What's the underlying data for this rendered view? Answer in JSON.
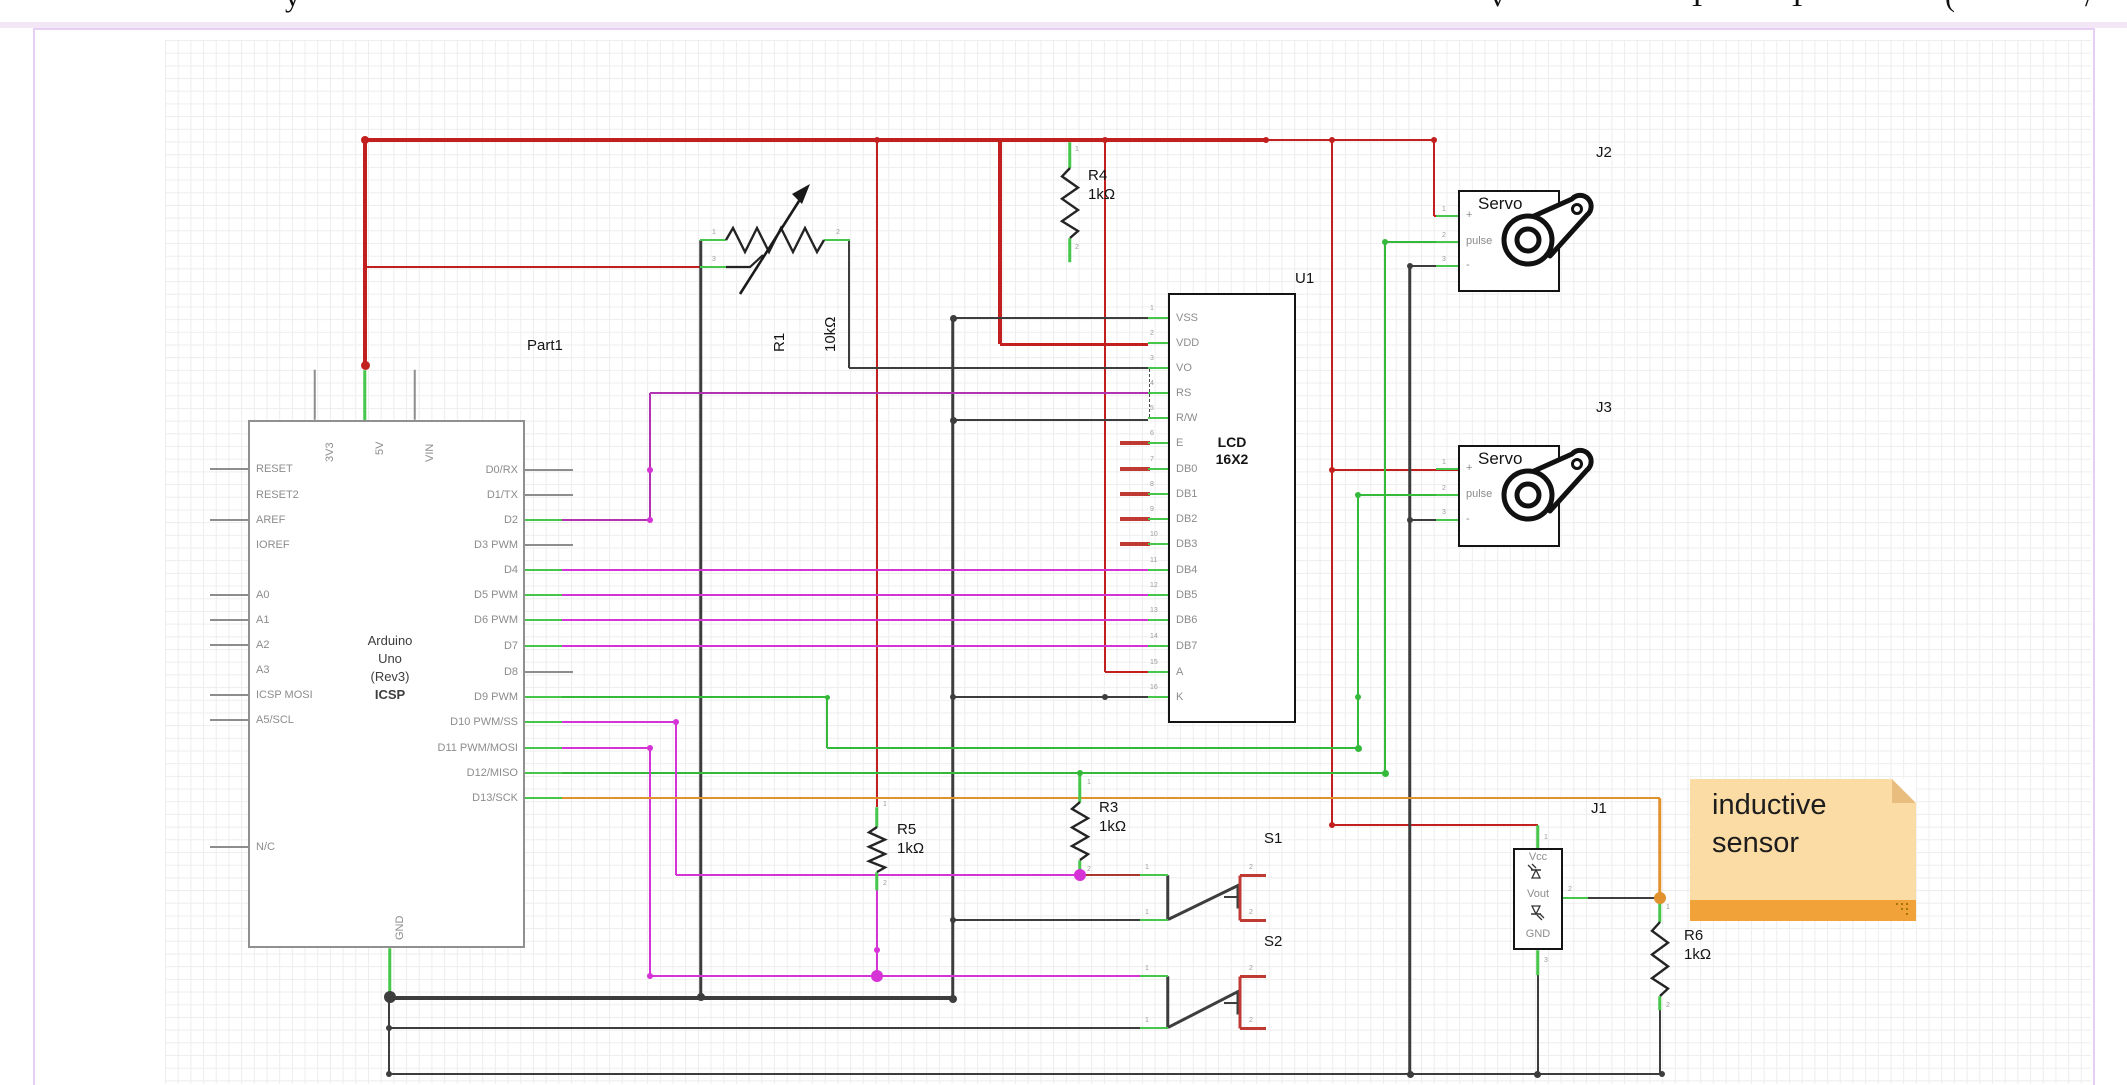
{
  "palette": {
    "r": "#c2201f",
    "dr": "#a8372f",
    "k": "#3d3d3d",
    "g": "#35b93a",
    "s": "#46c64b",
    "m": "#d633d6",
    "p": "#b233b2",
    "o": "#e1912d",
    "gy": "#8d8d8d",
    "rs": "#c03a34"
  },
  "title_fragments": [
    {
      "t": "y",
      "x": 285
    },
    {
      "t": "v",
      "x": 1490
    },
    {
      "t": "T",
      "x": 1688
    },
    {
      "t": "T",
      "x": 1788
    },
    {
      "t": "(",
      "x": 1945
    },
    {
      "t": "/",
      "x": 2085
    }
  ],
  "arduino": {
    "ref": "Part1",
    "ref_pos": {
      "x": 527,
      "y": 337
    },
    "box": {
      "x": 248,
      "y": 420,
      "w": 277,
      "h": 528
    },
    "title_lines": [
      "Arduino",
      "Uno",
      "(Rev3)",
      "ICSP"
    ],
    "top_pins": [
      {
        "label": "3V3",
        "x": 315,
        "stub": "gray"
      },
      {
        "label": "5V",
        "x": 365,
        "stub": "green"
      },
      {
        "label": "VIN",
        "x": 415,
        "stub": "gray"
      }
    ],
    "bottom_pins": [
      {
        "label": "GND",
        "x": 390
      }
    ],
    "left_pins": [
      {
        "label": "RESET",
        "y": 469,
        "stub": true
      },
      {
        "label": "RESET2",
        "y": 495,
        "stub": false
      },
      {
        "label": "AREF",
        "y": 520,
        "stub": true
      },
      {
        "label": "IOREF",
        "y": 545,
        "stub": false
      },
      {
        "label": "A0",
        "y": 595,
        "stub": true
      },
      {
        "label": "A1",
        "y": 620,
        "stub": true
      },
      {
        "label": "A2",
        "y": 645,
        "stub": true
      },
      {
        "label": "A3",
        "y": 670,
        "stub": false
      },
      {
        "label": "ICSP MOSI",
        "y": 695,
        "stub": true
      },
      {
        "label": "A5/SCL",
        "y": 720,
        "stub": true
      },
      {
        "label": "N/C",
        "y": 847,
        "stub": true
      }
    ],
    "right_pins": [
      {
        "label": "D0/RX",
        "y": 470,
        "stub": "gray"
      },
      {
        "label": "D1/TX",
        "y": 495,
        "stub": "gray"
      },
      {
        "label": "D2",
        "y": 520,
        "stub": "green"
      },
      {
        "label": "D3 PWM",
        "y": 545,
        "stub": "gray"
      },
      {
        "label": "D4",
        "y": 570,
        "stub": "green"
      },
      {
        "label": "D5 PWM",
        "y": 595,
        "stub": "green"
      },
      {
        "label": "D6 PWM",
        "y": 620,
        "stub": "green"
      },
      {
        "label": "D7",
        "y": 646,
        "stub": "green"
      },
      {
        "label": "D8",
        "y": 672,
        "stub": "gray"
      },
      {
        "label": "D9 PWM",
        "y": 697,
        "stub": "green"
      },
      {
        "label": "D10 PWM/SS",
        "y": 722,
        "stub": "green"
      },
      {
        "label": "D11 PWM/MOSI",
        "y": 748,
        "stub": "green"
      },
      {
        "label": "D12/MISO",
        "y": 773,
        "stub": "green"
      },
      {
        "label": "D13/SCK",
        "y": 798,
        "stub": "green"
      }
    ]
  },
  "lcd": {
    "ref": "U1",
    "ref_pos": {
      "x": 1295,
      "y": 270
    },
    "box": {
      "x": 1168,
      "y": 293,
      "w": 128,
      "h": 430
    },
    "name_lines": [
      "LCD",
      "16X2"
    ],
    "pins": [
      {
        "n": 1,
        "label": "VSS",
        "y": 318,
        "stub": "green"
      },
      {
        "n": 2,
        "label": "VDD",
        "y": 343,
        "stub": "green"
      },
      {
        "n": 3,
        "label": "VO",
        "y": 368,
        "stub": "green"
      },
      {
        "n": 4,
        "label": "RS",
        "y": 393,
        "stub": "green"
      },
      {
        "n": 5,
        "label": "R/W",
        "y": 418,
        "stub": "green"
      },
      {
        "n": 6,
        "label": "E",
        "y": 443,
        "stub": "red"
      },
      {
        "n": 7,
        "label": "DB0",
        "y": 469,
        "stub": "red"
      },
      {
        "n": 8,
        "label": "DB1",
        "y": 494,
        "stub": "red"
      },
      {
        "n": 9,
        "label": "DB2",
        "y": 519,
        "stub": "red"
      },
      {
        "n": 10,
        "label": "DB3",
        "y": 544,
        "stub": "red"
      },
      {
        "n": 11,
        "label": "DB4",
        "y": 570,
        "stub": "green"
      },
      {
        "n": 12,
        "label": "DB5",
        "y": 595,
        "stub": "green"
      },
      {
        "n": 13,
        "label": "DB6",
        "y": 620,
        "stub": "green"
      },
      {
        "n": 14,
        "label": "DB7",
        "y": 646,
        "stub": "green"
      },
      {
        "n": 15,
        "label": "A",
        "y": 672,
        "stub": "green"
      },
      {
        "n": 16,
        "label": "K",
        "y": 697,
        "stub": "green"
      }
    ]
  },
  "servos": [
    {
      "ref": "J2",
      "ref_pos": {
        "x": 1596,
        "y": 144
      },
      "title": "Servo",
      "box": {
        "x": 1458,
        "y": 190,
        "w": 102,
        "h": 102
      },
      "pins": [
        {
          "n": 1,
          "label": "+",
          "y": 216
        },
        {
          "n": 2,
          "label": "pulse",
          "y": 242
        },
        {
          "n": 3,
          "label": "-",
          "y": 266
        }
      ]
    },
    {
      "ref": "J3",
      "ref_pos": {
        "x": 1596,
        "y": 399
      },
      "title": "Servo",
      "box": {
        "x": 1458,
        "y": 445,
        "w": 102,
        "h": 102
      },
      "pins": [
        {
          "n": 1,
          "label": "+",
          "y": 469
        },
        {
          "n": 2,
          "label": "pulse",
          "y": 495
        },
        {
          "n": 3,
          "label": "-",
          "y": 520
        }
      ]
    }
  ],
  "connector": {
    "ref": "J1",
    "ref_pos": {
      "x": 1591,
      "y": 800
    },
    "box": {
      "x": 1513,
      "y": 848,
      "w": 50,
      "h": 102
    },
    "pin_labels": [
      "Vcc",
      "Vout",
      "GND"
    ]
  },
  "switches": [
    {
      "ref": "S1",
      "ref_pos": {
        "x": 1264,
        "y": 830
      }
    },
    {
      "ref": "S2",
      "ref_pos": {
        "x": 1264,
        "y": 933
      }
    }
  ],
  "resistors": [
    {
      "ref": "R1",
      "value": "10kΩ",
      "type": "pot",
      "label": {
        "x": 737,
        "y": 352,
        "rot": true
      }
    },
    {
      "ref": "R4",
      "value": "1kΩ",
      "x": 1070,
      "y": 168,
      "len": 70,
      "label": {
        "x": 1088,
        "y": 166
      }
    },
    {
      "ref": "R5",
      "value": "1kΩ",
      "x": 877,
      "y": 827,
      "len": 45,
      "label": {
        "x": 897,
        "y": 820
      }
    },
    {
      "ref": "R3",
      "value": "1kΩ",
      "x": 1080,
      "y": 802,
      "len": 58,
      "label": {
        "x": 1099,
        "y": 798
      }
    },
    {
      "ref": "R6",
      "value": "1kΩ",
      "x": 1660,
      "y": 922,
      "len": 74,
      "label": {
        "x": 1684,
        "y": 926
      }
    }
  ],
  "note": {
    "lines": [
      "inductive",
      "sensor"
    ]
  },
  "wires": [
    [
      "r",
      365,
      140,
      1266,
      140,
      4
    ],
    [
      "r",
      1266,
      140,
      1434,
      140,
      2
    ],
    [
      "r",
      365,
      140,
      365,
      365,
      4
    ],
    [
      "r",
      1000,
      140,
      1000,
      344,
      4
    ],
    [
      "r",
      1000,
      344,
      1148,
      344,
      3
    ],
    [
      "r",
      365,
      267,
      700,
      267,
      2
    ],
    [
      "r",
      877,
      140,
      877,
      807,
      2
    ],
    [
      "r",
      1105,
      140,
      1105,
      672,
      2
    ],
    [
      "r",
      1105,
      672,
      1148,
      672,
      2
    ],
    [
      "r",
      1332,
      140,
      1332,
      825,
      2
    ],
    [
      "r",
      1332,
      470,
      1458,
      470,
      2
    ],
    [
      "r",
      1332,
      825,
      1538,
      825,
      2
    ],
    [
      "r",
      1434,
      140,
      1434,
      216,
      2
    ],
    [
      "r",
      1434,
      216,
      1458,
      216,
      2
    ],
    [
      "dr",
      1080,
      875,
      1142,
      875,
      2
    ],
    [
      "k",
      701,
      240,
      701,
      997,
      2.5
    ],
    [
      "k",
      849,
      240,
      849,
      368,
      2
    ],
    [
      "k",
      849,
      368,
      1148,
      368,
      2
    ],
    [
      "k",
      953,
      318,
      1148,
      318,
      2
    ],
    [
      "k",
      953,
      318,
      953,
      999,
      2.5
    ],
    [
      "k",
      953,
      420,
      1148,
      420,
      2
    ],
    [
      "k",
      953,
      697,
      1148,
      697,
      2
    ],
    [
      "k",
      953,
      920,
      1142,
      920,
      2
    ],
    [
      "k",
      390,
      998,
      953,
      998,
      4
    ],
    [
      "k",
      389,
      997,
      389,
      1074,
      2
    ],
    [
      "k",
      389,
      1028,
      1142,
      1028,
      2
    ],
    [
      "k",
      389,
      1074,
      1662,
      1074,
      2.5
    ],
    [
      "k",
      1410,
      266,
      1410,
      1074,
      2.5
    ],
    [
      "k",
      1410,
      266,
      1436,
      266,
      2
    ],
    [
      "k",
      1410,
      520,
      1458,
      520,
      2
    ],
    [
      "k",
      1588,
      898,
      1658,
      898,
      2
    ],
    [
      "k",
      1538,
      975,
      1538,
      1074,
      2
    ],
    [
      "k",
      1660,
      1010,
      1660,
      1074,
      2
    ],
    [
      "k",
      1168,
      875,
      1168,
      920,
      2.5
    ],
    [
      "k",
      1168,
      919,
      1240,
      884,
      2.5
    ],
    [
      "k",
      1238,
      886,
      1238,
      908,
      3
    ],
    [
      "k",
      1224,
      897,
      1238,
      897,
      2
    ],
    [
      "k",
      1168,
      976,
      1168,
      1028,
      2.5
    ],
    [
      "k",
      1168,
      1027,
      1240,
      990,
      2.5
    ],
    [
      "k",
      1238,
      992,
      1238,
      1014,
      3
    ],
    [
      "k",
      1224,
      1003,
      1238,
      1003,
      2
    ],
    [
      "rs",
      1240,
      875,
      1266,
      875,
      3
    ],
    [
      "rs",
      1240,
      875,
      1240,
      920,
      3
    ],
    [
      "rs",
      1240,
      920,
      1266,
      920,
      3
    ],
    [
      "rs",
      1240,
      976,
      1266,
      976,
      3
    ],
    [
      "rs",
      1240,
      976,
      1240,
      1028,
      3
    ],
    [
      "rs",
      1240,
      1028,
      1266,
      1028,
      3
    ],
    [
      "g",
      560,
      697,
      827,
      697,
      2
    ],
    [
      "g",
      827,
      697,
      827,
      748,
      2
    ],
    [
      "g",
      827,
      748,
      1358,
      748,
      2
    ],
    [
      "g",
      1358,
      748,
      1358,
      495,
      2
    ],
    [
      "g",
      1358,
      495,
      1458,
      495,
      2
    ],
    [
      "g",
      560,
      773,
      1385,
      773,
      2
    ],
    [
      "g",
      1385,
      773,
      1385,
      242,
      2
    ],
    [
      "g",
      1385,
      242,
      1458,
      242,
      2
    ],
    [
      "m",
      560,
      570,
      1148,
      570,
      2
    ],
    [
      "m",
      560,
      595,
      1148,
      595,
      2
    ],
    [
      "m",
      560,
      620,
      1148,
      620,
      2
    ],
    [
      "m",
      560,
      646,
      1148,
      646,
      2
    ],
    [
      "m",
      560,
      722,
      676,
      722,
      2
    ],
    [
      "m",
      676,
      722,
      676,
      875,
      2
    ],
    [
      "m",
      676,
      875,
      1080,
      875,
      2
    ],
    [
      "m",
      560,
      748,
      650,
      748,
      2
    ],
    [
      "m",
      650,
      748,
      650,
      976,
      2
    ],
    [
      "m",
      650,
      976,
      1142,
      976,
      2
    ],
    [
      "m",
      877,
      890,
      877,
      976,
      2
    ],
    [
      "p",
      560,
      520,
      650,
      520,
      2
    ],
    [
      "p",
      650,
      520,
      650,
      393,
      2
    ],
    [
      "p",
      650,
      393,
      1148,
      393,
      2
    ],
    [
      "o",
      560,
      798,
      1660,
      798,
      2.5
    ],
    [
      "o",
      1660,
      798,
      1660,
      898,
      2.5
    ],
    [
      "s",
      365,
      370,
      365,
      420,
      2.5
    ],
    [
      "s",
      390,
      948,
      390,
      997,
      2.5
    ],
    [
      "s",
      1538,
      825,
      1538,
      848,
      2.5
    ],
    [
      "s",
      1563,
      898,
      1588,
      898,
      2.5
    ],
    [
      "s",
      1538,
      950,
      1538,
      975,
      2.5
    ],
    [
      "s",
      1070,
      142,
      1070,
      168,
      2.5
    ],
    [
      "s",
      1070,
      238,
      1070,
      262,
      2.5
    ],
    [
      "s",
      877,
      807,
      877,
      827,
      2.5
    ],
    [
      "s",
      877,
      872,
      877,
      890,
      2.5
    ],
    [
      "s",
      1080,
      773,
      1080,
      802,
      2.5
    ],
    [
      "s",
      1080,
      860,
      1080,
      876,
      2.5
    ],
    [
      "s",
      1660,
      898,
      1660,
      922,
      2.5
    ],
    [
      "s",
      1660,
      996,
      1660,
      1010,
      2.5
    ],
    [
      "s",
      700,
      240,
      726,
      240,
      2.5
    ],
    [
      "s",
      824,
      240,
      850,
      240,
      2.5
    ],
    [
      "s",
      700,
      267,
      726,
      267,
      2.5
    ],
    [
      "s",
      1140,
      875,
      1168,
      875,
      2.5
    ],
    [
      "s",
      1140,
      920,
      1168,
      920,
      2.5
    ],
    [
      "s",
      1140,
      976,
      1168,
      976,
      2.5
    ],
    [
      "s",
      1140,
      1028,
      1168,
      1028,
      2.5
    ],
    [
      "gy",
      315,
      370,
      315,
      420,
      1.5
    ],
    [
      "gy",
      415,
      370,
      415,
      420,
      1.5
    ]
  ],
  "dots": [
    [
      "r",
      365,
      140,
      4
    ],
    [
      "r",
      365,
      365,
      4.5
    ],
    [
      "r",
      877,
      140,
      3
    ],
    [
      "r",
      1105,
      140,
      3
    ],
    [
      "r",
      1266,
      140,
      3
    ],
    [
      "r",
      1332,
      140,
      3
    ],
    [
      "r",
      1434,
      140,
      3
    ],
    [
      "r",
      1332,
      470,
      3
    ],
    [
      "r",
      1332,
      825,
      3
    ],
    [
      "k",
      390,
      997,
      6
    ],
    [
      "k",
      701,
      997,
      4
    ],
    [
      "k",
      953,
      318,
      3.5
    ],
    [
      "k",
      953,
      420,
      3.5
    ],
    [
      "k",
      953,
      697,
      3
    ],
    [
      "k",
      953,
      920,
      3
    ],
    [
      "k",
      953,
      999,
      4
    ],
    [
      "k",
      1105,
      697,
      3
    ],
    [
      "k",
      389,
      1028,
      3
    ],
    [
      "k",
      389,
      1074,
      3
    ],
    [
      "k",
      1410,
      266,
      3
    ],
    [
      "k",
      1410,
      520,
      3
    ],
    [
      "k",
      1410,
      1074,
      3.5
    ],
    [
      "k",
      1537,
      1074,
      3.5
    ],
    [
      "k",
      1662,
      1074,
      3
    ],
    [
      "g",
      827,
      697,
      2.5
    ],
    [
      "g",
      1358,
      748,
      3.5
    ],
    [
      "g",
      1358,
      697,
      3
    ],
    [
      "g",
      1358,
      495,
      3
    ],
    [
      "g",
      1385,
      773,
      3.5
    ],
    [
      "g",
      1385,
      242,
      3
    ],
    [
      "g",
      1080,
      773,
      3
    ],
    [
      "m",
      1080,
      875,
      6
    ],
    [
      "m",
      877,
      976,
      6
    ],
    [
      "m",
      650,
      470,
      3
    ],
    [
      "m",
      650,
      520,
      3
    ],
    [
      "m",
      650,
      748,
      3
    ],
    [
      "m",
      650,
      976,
      3
    ],
    [
      "m",
      877,
      950,
      3
    ],
    [
      "m",
      676,
      722,
      3
    ],
    [
      "o",
      1660,
      898,
      6
    ]
  ],
  "pin_nums": [
    {
      "t": "1",
      "x": 1442,
      "y": 206
    },
    {
      "t": "2",
      "x": 1442,
      "y": 232
    },
    {
      "t": "3",
      "x": 1442,
      "y": 256
    },
    {
      "t": "1",
      "x": 1442,
      "y": 459
    },
    {
      "t": "2",
      "x": 1442,
      "y": 485
    },
    {
      "t": "3",
      "x": 1442,
      "y": 509
    },
    {
      "t": "1",
      "x": 712,
      "y": 229
    },
    {
      "t": "2",
      "x": 836,
      "y": 229
    },
    {
      "t": "3",
      "x": 712,
      "y": 256
    },
    {
      "t": "1",
      "x": 1544,
      "y": 834
    },
    {
      "t": "2",
      "x": 1568,
      "y": 886
    },
    {
      "t": "3",
      "x": 1544,
      "y": 957
    },
    {
      "t": "1",
      "x": 1145,
      "y": 864
    },
    {
      "t": "1",
      "x": 1145,
      "y": 909
    },
    {
      "t": "2",
      "x": 1249,
      "y": 864
    },
    {
      "t": "2",
      "x": 1249,
      "y": 909
    },
    {
      "t": "1",
      "x": 1145,
      "y": 965
    },
    {
      "t": "1",
      "x": 1145,
      "y": 1017
    },
    {
      "t": "2",
      "x": 1249,
      "y": 965
    },
    {
      "t": "2",
      "x": 1249,
      "y": 1017
    },
    {
      "t": "1",
      "x": 1075,
      "y": 146
    },
    {
      "t": "2",
      "x": 1075,
      "y": 244
    },
    {
      "t": "1",
      "x": 883,
      "y": 801
    },
    {
      "t": "2",
      "x": 883,
      "y": 880
    },
    {
      "t": "1",
      "x": 1087,
      "y": 779
    },
    {
      "t": "2",
      "x": 1087,
      "y": 866
    },
    {
      "t": "1",
      "x": 1666,
      "y": 904
    },
    {
      "t": "2",
      "x": 1666,
      "y": 1002
    }
  ]
}
